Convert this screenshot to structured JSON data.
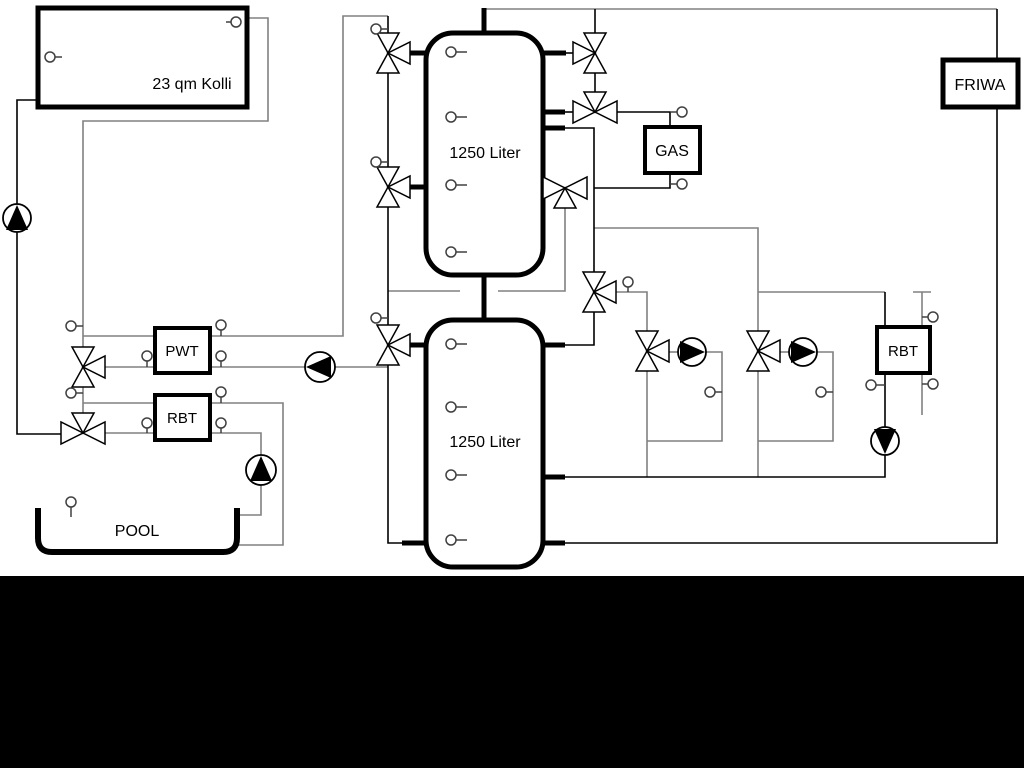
{
  "diagram": {
    "title": "Hydraulic heating schematic with solar collector, buffer tanks, gas boiler, FRIWA and pool",
    "labels": {
      "collector": "23 qm Kolli",
      "tank_top": "1250 Liter",
      "tank_bottom": "1250 Liter",
      "gas": "GAS",
      "friwa": "FRIWA",
      "pwt": "PWT",
      "rbt_left": "RBT",
      "rbt_right": "RBT",
      "pool": "POOL"
    },
    "colors": {
      "line_black": "#000000",
      "line_gray": "#808080",
      "background": "#ffffff",
      "bottom_bar": "#000000",
      "symbol_fill": "#ffffff"
    },
    "icons": {
      "pump": "circle-with-filled-triangle",
      "three_way_valve": "three-outlined-triangles",
      "sensor": "small-circle-with-stem"
    }
  }
}
